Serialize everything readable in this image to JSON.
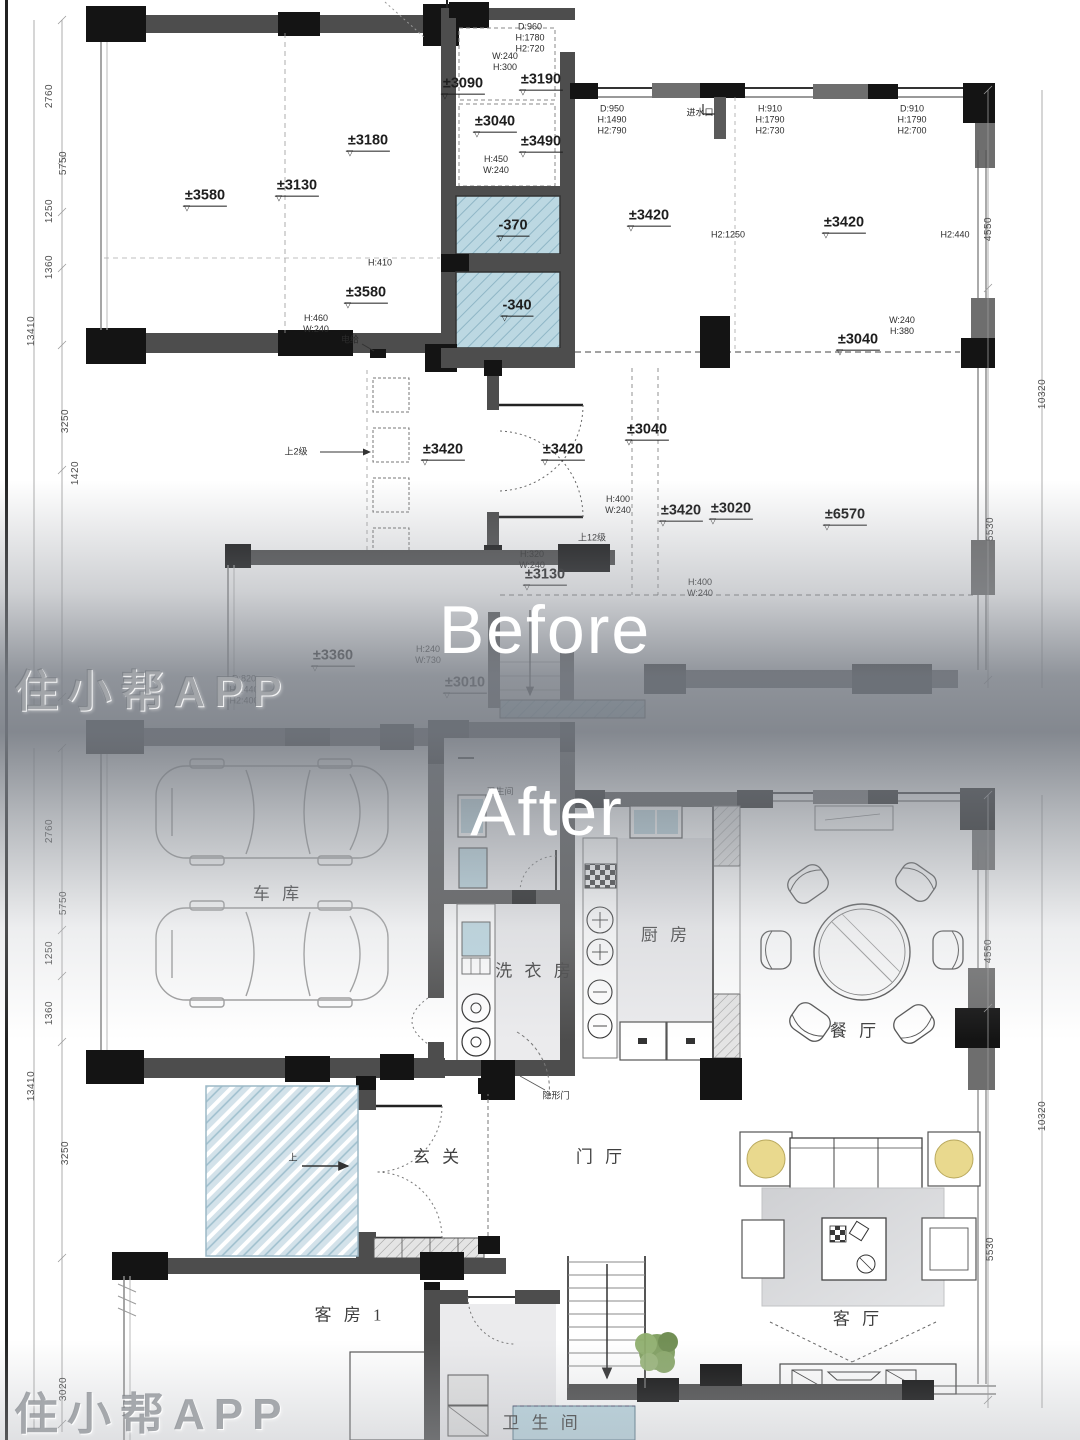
{
  "meta": {
    "title": "住宅平面改造前后对比图",
    "width": 1080,
    "height": 1440
  },
  "colors": {
    "wall": "#4d4d4d",
    "column": "#141414",
    "hatch_blue": "#bcd8e2",
    "glass": "#d3e2ea",
    "lamp_yellow": "#e9d98e",
    "plant_green": "#7d9c5c",
    "caption_white": "#ffffff"
  },
  "overlay": {
    "before_label": "Before",
    "after_label": "After",
    "watermark": "住小帮APP"
  },
  "before": {
    "elevations": [
      {
        "t": "±3580",
        "x": 205,
        "y": 197
      },
      {
        "t": "±3180",
        "x": 368,
        "y": 142
      },
      {
        "t": "±3130",
        "x": 297,
        "y": 187
      },
      {
        "t": "±3090",
        "x": 463,
        "y": 85
      },
      {
        "t": "±3190",
        "x": 541,
        "y": 81
      },
      {
        "t": "±3040",
        "x": 495,
        "y": 123
      },
      {
        "t": "±3490",
        "x": 541,
        "y": 143
      },
      {
        "t": "±3420",
        "x": 649,
        "y": 217
      },
      {
        "t": "±3420",
        "x": 844,
        "y": 224
      },
      {
        "t": "±3040",
        "x": 858,
        "y": 341
      },
      {
        "t": "-370",
        "x": 513,
        "y": 227
      },
      {
        "t": "-340",
        "x": 517,
        "y": 307
      },
      {
        "t": "±3580",
        "x": 366,
        "y": 294
      },
      {
        "t": "±3420",
        "x": 443,
        "y": 451
      },
      {
        "t": "±3420",
        "x": 563,
        "y": 451
      },
      {
        "t": "±3040",
        "x": 647,
        "y": 431
      },
      {
        "t": "±3420",
        "x": 681,
        "y": 512
      },
      {
        "t": "±3020",
        "x": 731,
        "y": 510
      },
      {
        "t": "±6570",
        "x": 845,
        "y": 516
      },
      {
        "t": "±3130",
        "x": 545,
        "y": 576
      },
      {
        "t": "±3360",
        "x": 333,
        "y": 657
      },
      {
        "t": "±3010",
        "x": 465,
        "y": 684
      }
    ],
    "notes": [
      {
        "t": "D:960\nH:1780\nH2:720",
        "x": 530,
        "y": 38
      },
      {
        "t": "W:240\nH:300",
        "x": 505,
        "y": 62
      },
      {
        "t": "H:450\nW:240",
        "x": 496,
        "y": 165
      },
      {
        "t": "D:950\nH:1490\nH2:790",
        "x": 612,
        "y": 120
      },
      {
        "t": "进水口",
        "x": 700,
        "y": 113
      },
      {
        "t": "H:910\nH:1790\nH2:730",
        "x": 770,
        "y": 120
      },
      {
        "t": "D:910\nH:1790\nH2:700",
        "x": 912,
        "y": 120
      },
      {
        "t": "H2:1250",
        "x": 728,
        "y": 235
      },
      {
        "t": "H2:440",
        "x": 955,
        "y": 235
      },
      {
        "t": "W:240\nH:380",
        "x": 902,
        "y": 326
      },
      {
        "t": "H:410",
        "x": 380,
        "y": 263
      },
      {
        "t": "H:460\nW:240",
        "x": 316,
        "y": 324
      },
      {
        "t": "电给",
        "x": 350,
        "y": 340
      },
      {
        "t": "上2级",
        "x": 296,
        "y": 452
      },
      {
        "t": "H:400\nW:240",
        "x": 618,
        "y": 505
      },
      {
        "t": "上12级",
        "x": 592,
        "y": 538
      },
      {
        "t": "H:320\nW:240",
        "x": 532,
        "y": 560
      },
      {
        "t": "H:240\nW:730",
        "x": 428,
        "y": 655
      },
      {
        "t": "H:400\nW:240",
        "x": 700,
        "y": 588
      },
      {
        "t": "D:820\nH:2440\nH2:400",
        "x": 244,
        "y": 690
      }
    ]
  },
  "after": {
    "rooms": [
      {
        "t": "车  库",
        "x": 278,
        "y": 895
      },
      {
        "t": "洗 衣 房",
        "x": 535,
        "y": 972
      },
      {
        "t": "厨  房",
        "x": 666,
        "y": 936
      },
      {
        "t": "餐  厅",
        "x": 855,
        "y": 1032
      },
      {
        "t": "玄  关",
        "x": 438,
        "y": 1158
      },
      {
        "t": "门  厅",
        "x": 601,
        "y": 1158
      },
      {
        "t": "客 房 1",
        "x": 350,
        "y": 1316
      },
      {
        "t": "客  厅",
        "x": 858,
        "y": 1320
      },
      {
        "t": "卫 生 间",
        "x": 542,
        "y": 1424
      }
    ],
    "notes": [
      {
        "t": "隐形门",
        "x": 556,
        "y": 1096
      },
      {
        "t": "上",
        "x": 293,
        "y": 1158
      },
      {
        "t": "卫生间",
        "x": 500,
        "y": 792
      }
    ]
  },
  "dims": {
    "items": [
      {
        "t": "2760",
        "x": 50,
        "y": 96
      },
      {
        "t": "5750",
        "x": 64,
        "y": 163
      },
      {
        "t": "1250",
        "x": 50,
        "y": 211
      },
      {
        "t": "1360",
        "x": 50,
        "y": 267
      },
      {
        "t": "13410",
        "x": 32,
        "y": 331
      },
      {
        "t": "3250",
        "x": 66,
        "y": 421
      },
      {
        "t": "1420",
        "x": 76,
        "y": 473
      },
      {
        "t": "4550",
        "x": 989,
        "y": 229
      },
      {
        "t": "5530",
        "x": 991,
        "y": 529
      },
      {
        "t": "10320",
        "x": 1043,
        "y": 394
      },
      {
        "t": "2760",
        "x": 50,
        "y": 831
      },
      {
        "t": "5750",
        "x": 64,
        "y": 903
      },
      {
        "t": "1250",
        "x": 50,
        "y": 953
      },
      {
        "t": "1360",
        "x": 50,
        "y": 1013
      },
      {
        "t": "13410",
        "x": 32,
        "y": 1086
      },
      {
        "t": "3250",
        "x": 66,
        "y": 1153
      },
      {
        "t": "3020",
        "x": 64,
        "y": 1389
      },
      {
        "t": "4550",
        "x": 989,
        "y": 951
      },
      {
        "t": "5530",
        "x": 991,
        "y": 1249
      },
      {
        "t": "10320",
        "x": 1043,
        "y": 1116
      }
    ]
  }
}
